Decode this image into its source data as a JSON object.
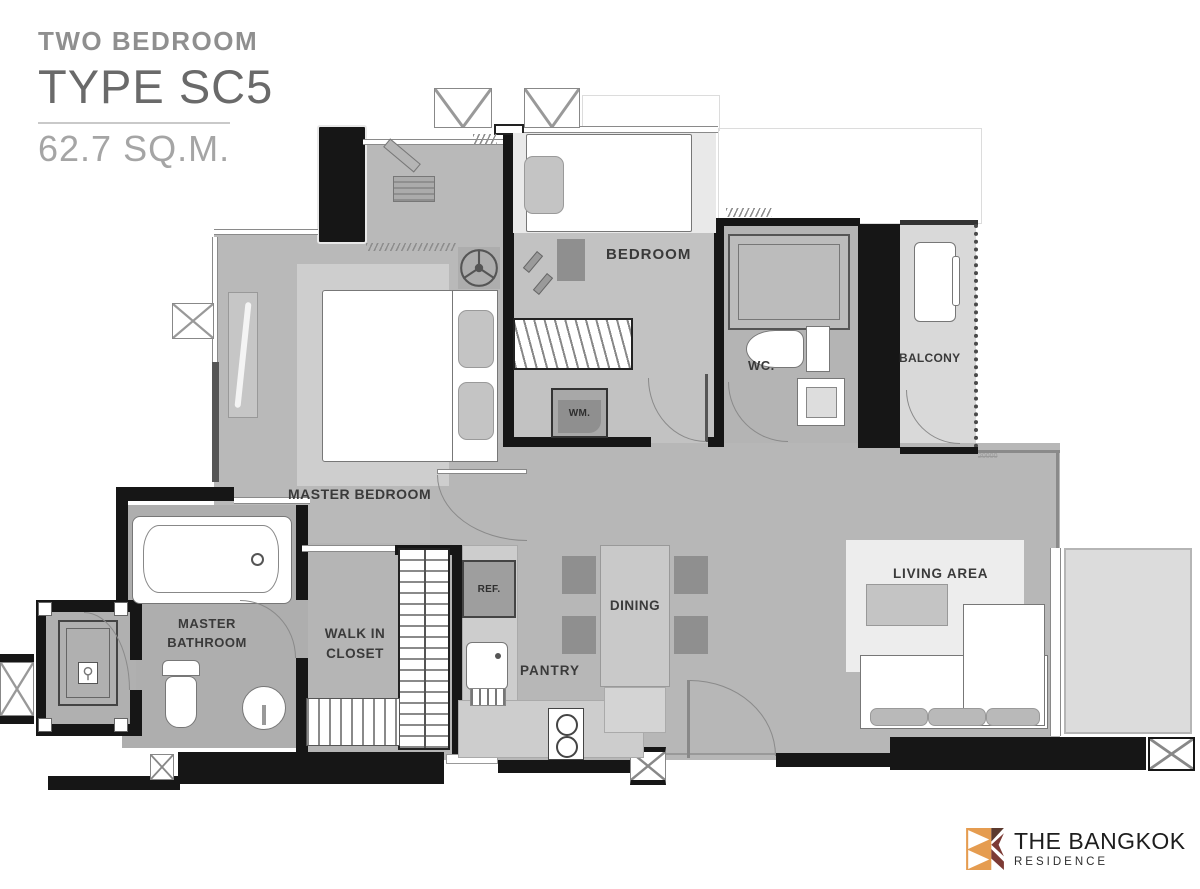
{
  "title_block": {
    "type_label": "TWO BEDROOM",
    "type_name": "TYPE SC5",
    "area": "62.7 SQ.M."
  },
  "labels": {
    "master_bedroom": "MASTER BEDROOM",
    "bedroom": "BEDROOM",
    "wc": "WC.",
    "balcony": "BALCONY",
    "master_bathroom_line1": "MASTER",
    "master_bathroom_line2": "BATHROOM",
    "walk_in_closet_line1": "WALK IN",
    "walk_in_closet_line2": "CLOSET",
    "living_area": "LIVING AREA",
    "dining": "DINING",
    "pantry": "PANTRY",
    "refrigerator": "REF.",
    "washing_machine": "WM."
  },
  "dimension_note": "20000",
  "logo": {
    "brand_line1": "THE BANGKOK",
    "brand_line2": "RESIDENCE",
    "accent_color": "#E59C50",
    "maroon_color": "#7C3A34",
    "brown_color": "#5B3A2E"
  },
  "colors": {
    "floor_gray": "#b9b9b9",
    "balcony_gray": "#dcdcdc",
    "wall_black": "#161616",
    "label_text": "#3a3a3a"
  }
}
